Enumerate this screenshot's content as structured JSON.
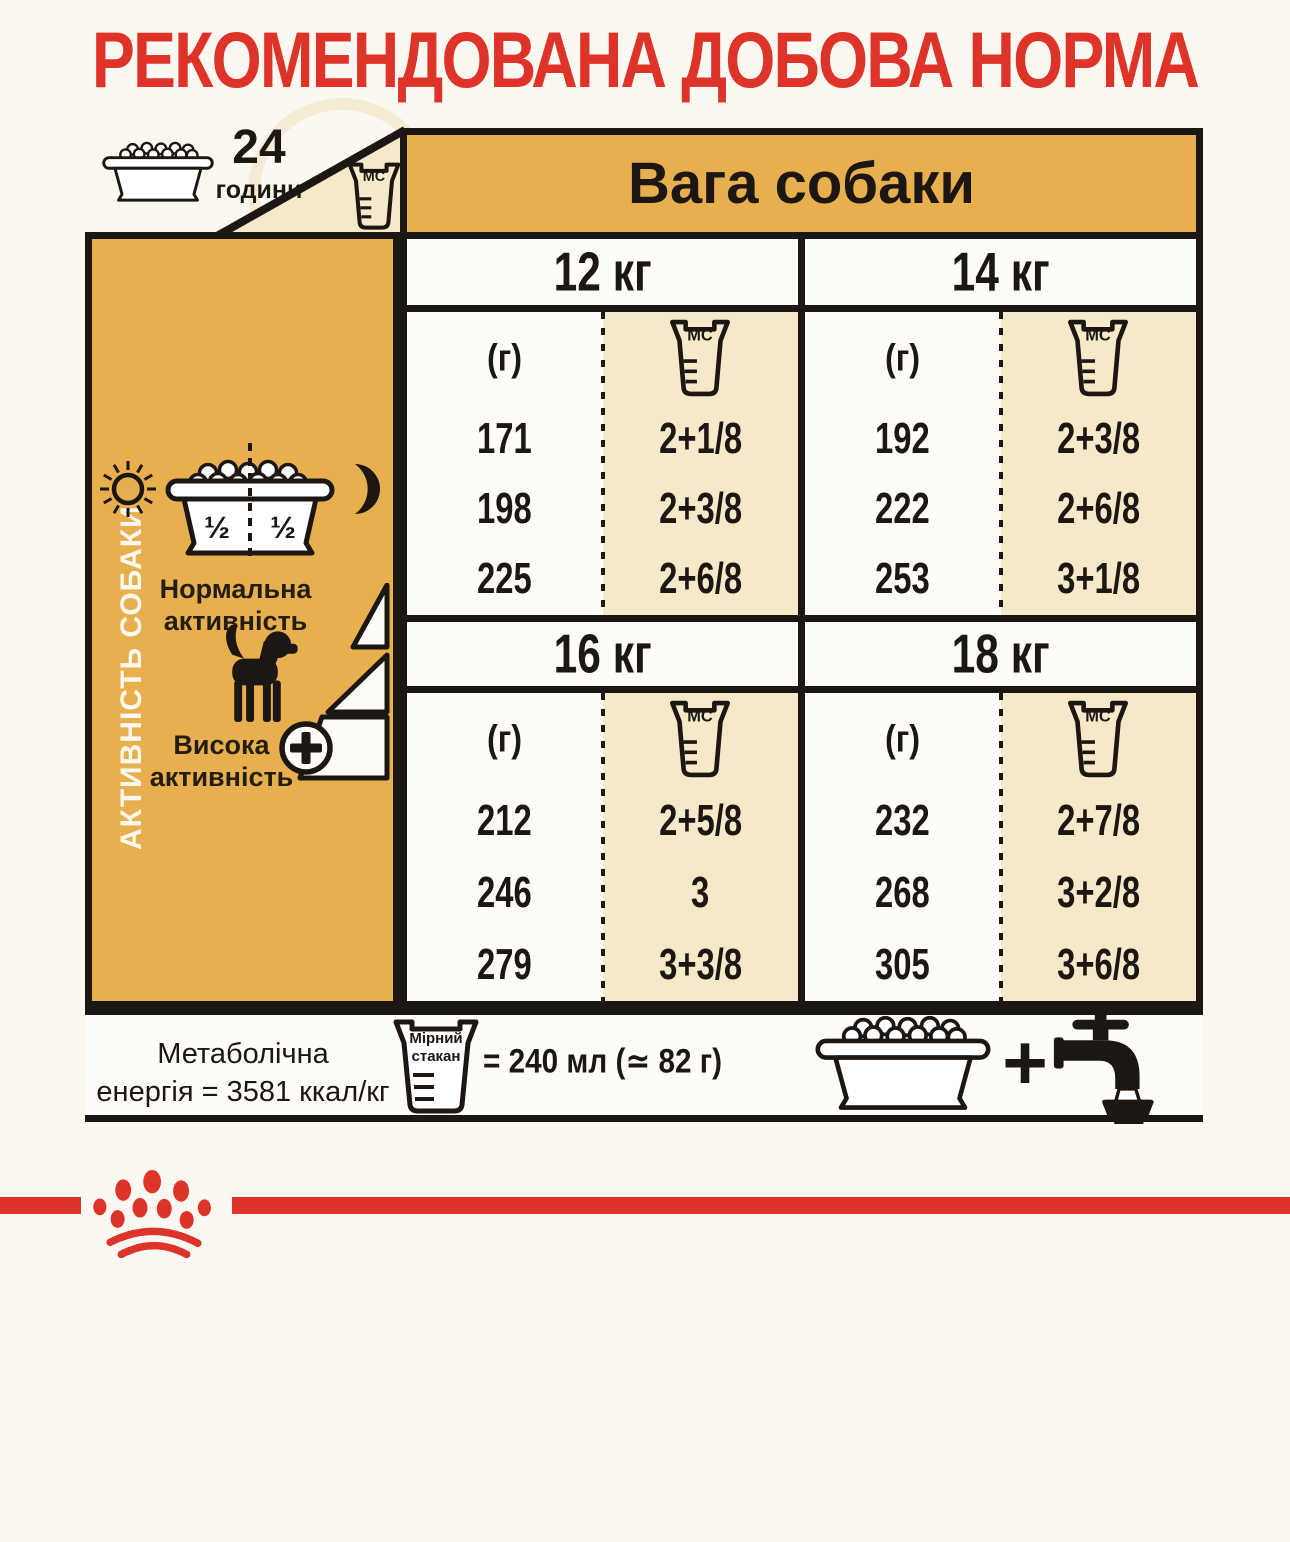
{
  "title": "РЕКОМЕНДОВАНА ДОБОВА НОРМА",
  "badge": {
    "number": "24",
    "unit": "години"
  },
  "weight_header": "Вага собаки",
  "labels": {
    "mc": "MC",
    "grams": "(г)"
  },
  "sidebar": {
    "vertical_label": "АКТИВНІСТЬ СОБАКИ",
    "half_left": "½",
    "half_right": "½",
    "normal_1": "Нормальна",
    "normal_2": "активність",
    "high_1": "Висока",
    "high_2": "активність"
  },
  "groups": [
    {
      "weight": "12 кг",
      "rows": [
        {
          "g": "171",
          "mc": "2+1/8"
        },
        {
          "g": "198",
          "mc": "2+3/8"
        },
        {
          "g": "225",
          "mc": "2+6/8"
        }
      ]
    },
    {
      "weight": "14 кг",
      "rows": [
        {
          "g": "192",
          "mc": "2+3/8"
        },
        {
          "g": "222",
          "mc": "2+6/8"
        },
        {
          "g": "253",
          "mc": "3+1/8"
        }
      ]
    },
    {
      "weight": "16 кг",
      "rows": [
        {
          "g": "212",
          "mc": "2+5/8"
        },
        {
          "g": "246",
          "mc": "3"
        },
        {
          "g": "279",
          "mc": "3+3/8"
        }
      ]
    },
    {
      "weight": "18 кг",
      "rows": [
        {
          "g": "232",
          "mc": "2+7/8"
        },
        {
          "g": "268",
          "mc": "3+2/8"
        },
        {
          "g": "305",
          "mc": "3+6/8"
        }
      ]
    }
  ],
  "footer": {
    "energy_1": "Метаболічна",
    "energy_2": "енергія = 3581 ккал/кг",
    "cup_1": "Мірний",
    "cup_2": "стакан",
    "volume": "= 240 мл (≃ 82 г)",
    "plus": "+"
  },
  "colors": {
    "red": "#de3329",
    "orange": "#e8af4f",
    "cream": "#f6e9ca",
    "ink": "#1c1712",
    "paper": "#fbf8f1"
  },
  "icons": [
    "food-bowl-icon",
    "measuring-cup-icon",
    "sun-icon",
    "moon-icon",
    "half-bowl-icon",
    "dog-icon",
    "activity-triangles-icon",
    "plus-circle-icon",
    "faucet-icon",
    "crown-logo-icon"
  ],
  "chart_data": {
    "type": "table",
    "title": "Рекомендована добова норма",
    "columns": [
      "Вага собаки",
      "г",
      "Мірний стакан (MC)"
    ],
    "weights_kg": [
      12,
      14,
      16,
      18
    ],
    "rows": [
      {
        "weight_kg": 12,
        "grams": [
          171,
          198,
          225
        ],
        "cups": [
          "2+1/8",
          "2+3/8",
          "2+6/8"
        ]
      },
      {
        "weight_kg": 14,
        "grams": [
          192,
          222,
          253
        ],
        "cups": [
          "2+3/8",
          "2+6/8",
          "3+1/8"
        ]
      },
      {
        "weight_kg": 16,
        "grams": [
          212,
          246,
          279
        ],
        "cups": [
          "2+5/8",
          "3",
          "3+3/8"
        ]
      },
      {
        "weight_kg": 18,
        "grams": [
          232,
          268,
          305
        ],
        "cups": [
          "2+7/8",
          "3+2/8",
          "3+6/8"
        ]
      }
    ],
    "activity_labels": [
      "Нормальна активність",
      "Висока активність"
    ],
    "metabolic_energy": "3581 ккал/кг",
    "measuring_cup": "240 мл (≃ 82 г)",
    "feeding_schedule": "24 години, 1/2 + 1/2"
  }
}
